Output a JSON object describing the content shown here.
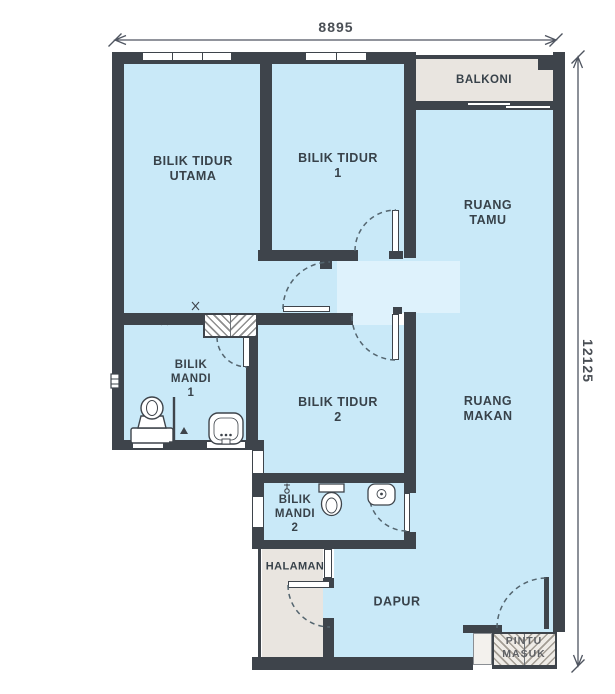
{
  "title": "Apartment floor plan",
  "dims": {
    "width": "8895",
    "height": "12125"
  },
  "rooms": {
    "utama": {
      "label": "BILIK TIDUR\nUTAMA"
    },
    "tidur1": {
      "label": "BILIK TIDUR\n1"
    },
    "balkoni": {
      "label": "BALKONI"
    },
    "tamu": {
      "label": "RUANG\nTAMU"
    },
    "makan": {
      "label": "RUANG\nMAKAN"
    },
    "mandi1": {
      "label": "BILIK\nMANDI\n1"
    },
    "tidur2": {
      "label": "BILIK TIDUR\n2"
    },
    "mandi2": {
      "label": "BILIK\nMANDI\n2"
    },
    "halaman": {
      "label": "HALAMAN"
    },
    "dapur": {
      "label": "DAPUR"
    },
    "pintu_masuk": {
      "label": "PINTU\nMASUK"
    }
  },
  "colors": {
    "wall": "#3e444b",
    "floor": "#c9e9f8",
    "hall": "#def2fc",
    "outdoor": "#e9e5e0",
    "arc": "#54656f",
    "label": "#38424a",
    "dim": "#4a4f55"
  }
}
